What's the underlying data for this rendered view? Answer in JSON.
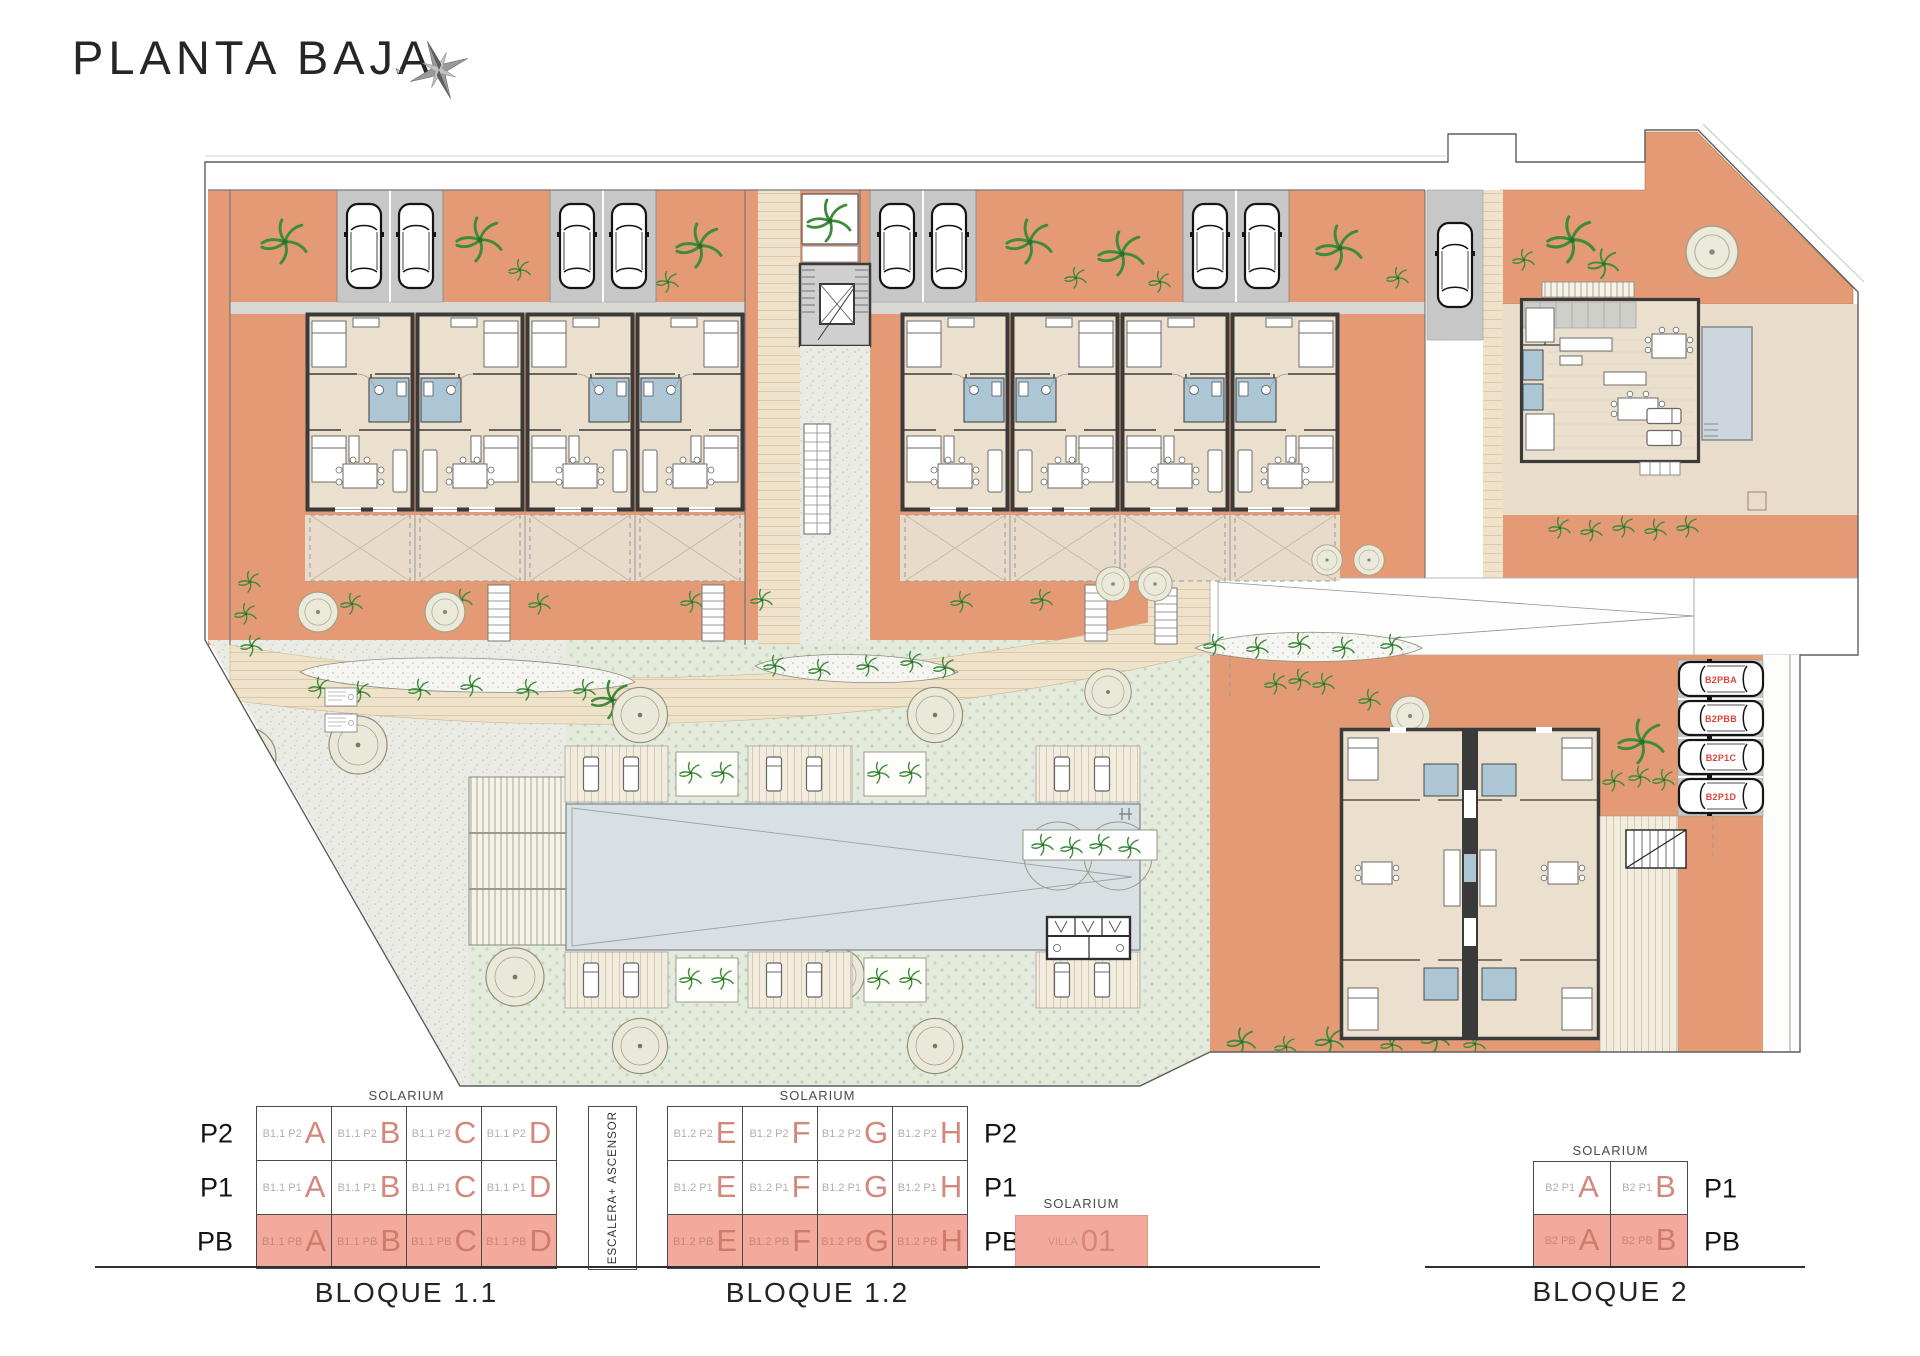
{
  "title": "PLANTA BAJA",
  "compass": {
    "north": "N"
  },
  "palette": {
    "terracotta": "#e49a74",
    "floor_beige": "#ebdfce",
    "terrace_beige": "#e8dbc9",
    "parking_gray": "#c7c7c7",
    "bathroom_blue": "#adc6d6",
    "pool_blue": "#d9e0e4",
    "lawn_green": "#e4ebdc",
    "wall_dark": "#3a3a3a",
    "legend_highlight": "#f3a99b",
    "legend_letter": "#d3887b",
    "parking_label_red": "#e0443a"
  },
  "plan": {
    "parking_labels": [
      "B2PBA",
      "B2PBB",
      "B2P1C",
      "B2P1D"
    ]
  },
  "legend": {
    "solarium": "SOLARIUM",
    "stair_label": "ESCALERA+ ASCENSOR",
    "villa": {
      "solarium": "SOLARIUM",
      "code": "VILLA",
      "number": "01"
    },
    "blocks": [
      {
        "id": "b11",
        "caption": "BLOQUE 1.1",
        "labels_side": "left",
        "rows": [
          {
            "floor": "P2",
            "highlight": false,
            "code": "B1.1 P2",
            "letters": [
              "A",
              "B",
              "C",
              "D"
            ]
          },
          {
            "floor": "P1",
            "highlight": false,
            "code": "B1.1 P1",
            "letters": [
              "A",
              "B",
              "C",
              "D"
            ]
          },
          {
            "floor": "PB",
            "highlight": true,
            "code": "B1.1 PB",
            "letters": [
              "A",
              "B",
              "C",
              "D"
            ]
          }
        ]
      },
      {
        "id": "b12",
        "caption": "BLOQUE 1.2",
        "labels_side": "right",
        "rows": [
          {
            "floor": "P2",
            "highlight": false,
            "code": "B1.2 P2",
            "letters": [
              "E",
              "F",
              "G",
              "H"
            ]
          },
          {
            "floor": "P1",
            "highlight": false,
            "code": "B1.2 P1",
            "letters": [
              "E",
              "F",
              "G",
              "H"
            ]
          },
          {
            "floor": "PB",
            "highlight": true,
            "code": "B1.2 PB",
            "letters": [
              "E",
              "F",
              "G",
              "H"
            ]
          }
        ]
      },
      {
        "id": "b2",
        "caption": "BLOQUE 2",
        "labels_side": "right",
        "rows": [
          {
            "floor": "P1",
            "highlight": false,
            "code": "B2 P1",
            "letters": [
              "A",
              "B"
            ]
          },
          {
            "floor": "PB",
            "highlight": true,
            "code": "B2 PB",
            "letters": [
              "A",
              "B"
            ]
          }
        ]
      }
    ]
  }
}
